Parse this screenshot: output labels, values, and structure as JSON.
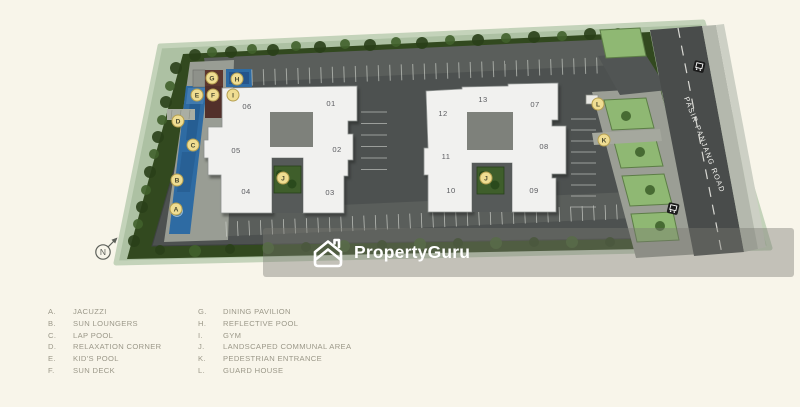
{
  "plan": {
    "north_label": "N",
    "road_name": "PASIR PANJANG ROAD",
    "buildings": [
      {
        "label": "06"
      },
      {
        "label": "01"
      },
      {
        "label": "05"
      },
      {
        "label": "02"
      },
      {
        "label": "04"
      },
      {
        "label": "03"
      },
      {
        "label": "12"
      },
      {
        "label": "13"
      },
      {
        "label": "07"
      },
      {
        "label": "11"
      },
      {
        "label": "08"
      },
      {
        "label": "10"
      },
      {
        "label": "09"
      }
    ],
    "markers": [
      {
        "letter": "A"
      },
      {
        "letter": "B"
      },
      {
        "letter": "C"
      },
      {
        "letter": "D"
      },
      {
        "letter": "E"
      },
      {
        "letter": "F"
      },
      {
        "letter": "G"
      },
      {
        "letter": "H"
      },
      {
        "letter": "I"
      },
      {
        "letter": "J"
      },
      {
        "letter": "J"
      },
      {
        "letter": "K"
      },
      {
        "letter": "L"
      }
    ],
    "colors": {
      "site_green": "#a9bfa0",
      "hedge_green": "#32491f",
      "pool_blue": "#2e6ba3",
      "marker_yellow": "#efdd92",
      "road_gray": "#494c4b"
    }
  },
  "watermark": {
    "brand": "PropertyGuru"
  },
  "legend": {
    "items": [
      {
        "letter": "A.",
        "label": "JACUZZI"
      },
      {
        "letter": "B.",
        "label": "SUN LOUNGERS"
      },
      {
        "letter": "C.",
        "label": "LAP POOL"
      },
      {
        "letter": "D.",
        "label": "RELAXATION CORNER"
      },
      {
        "letter": "E.",
        "label": "KID'S POOL"
      },
      {
        "letter": "F.",
        "label": "SUN DECK"
      },
      {
        "letter": "G.",
        "label": "DINING PAVILION"
      },
      {
        "letter": "H.",
        "label": "REFLECTIVE POOL"
      },
      {
        "letter": "I.",
        "label": "GYM"
      },
      {
        "letter": "J.",
        "label": "LANDSCAPED COMMUNAL AREA"
      },
      {
        "letter": "K.",
        "label": "PEDESTRIAN ENTRANCE"
      },
      {
        "letter": "L.",
        "label": "GUARD HOUSE"
      }
    ]
  }
}
